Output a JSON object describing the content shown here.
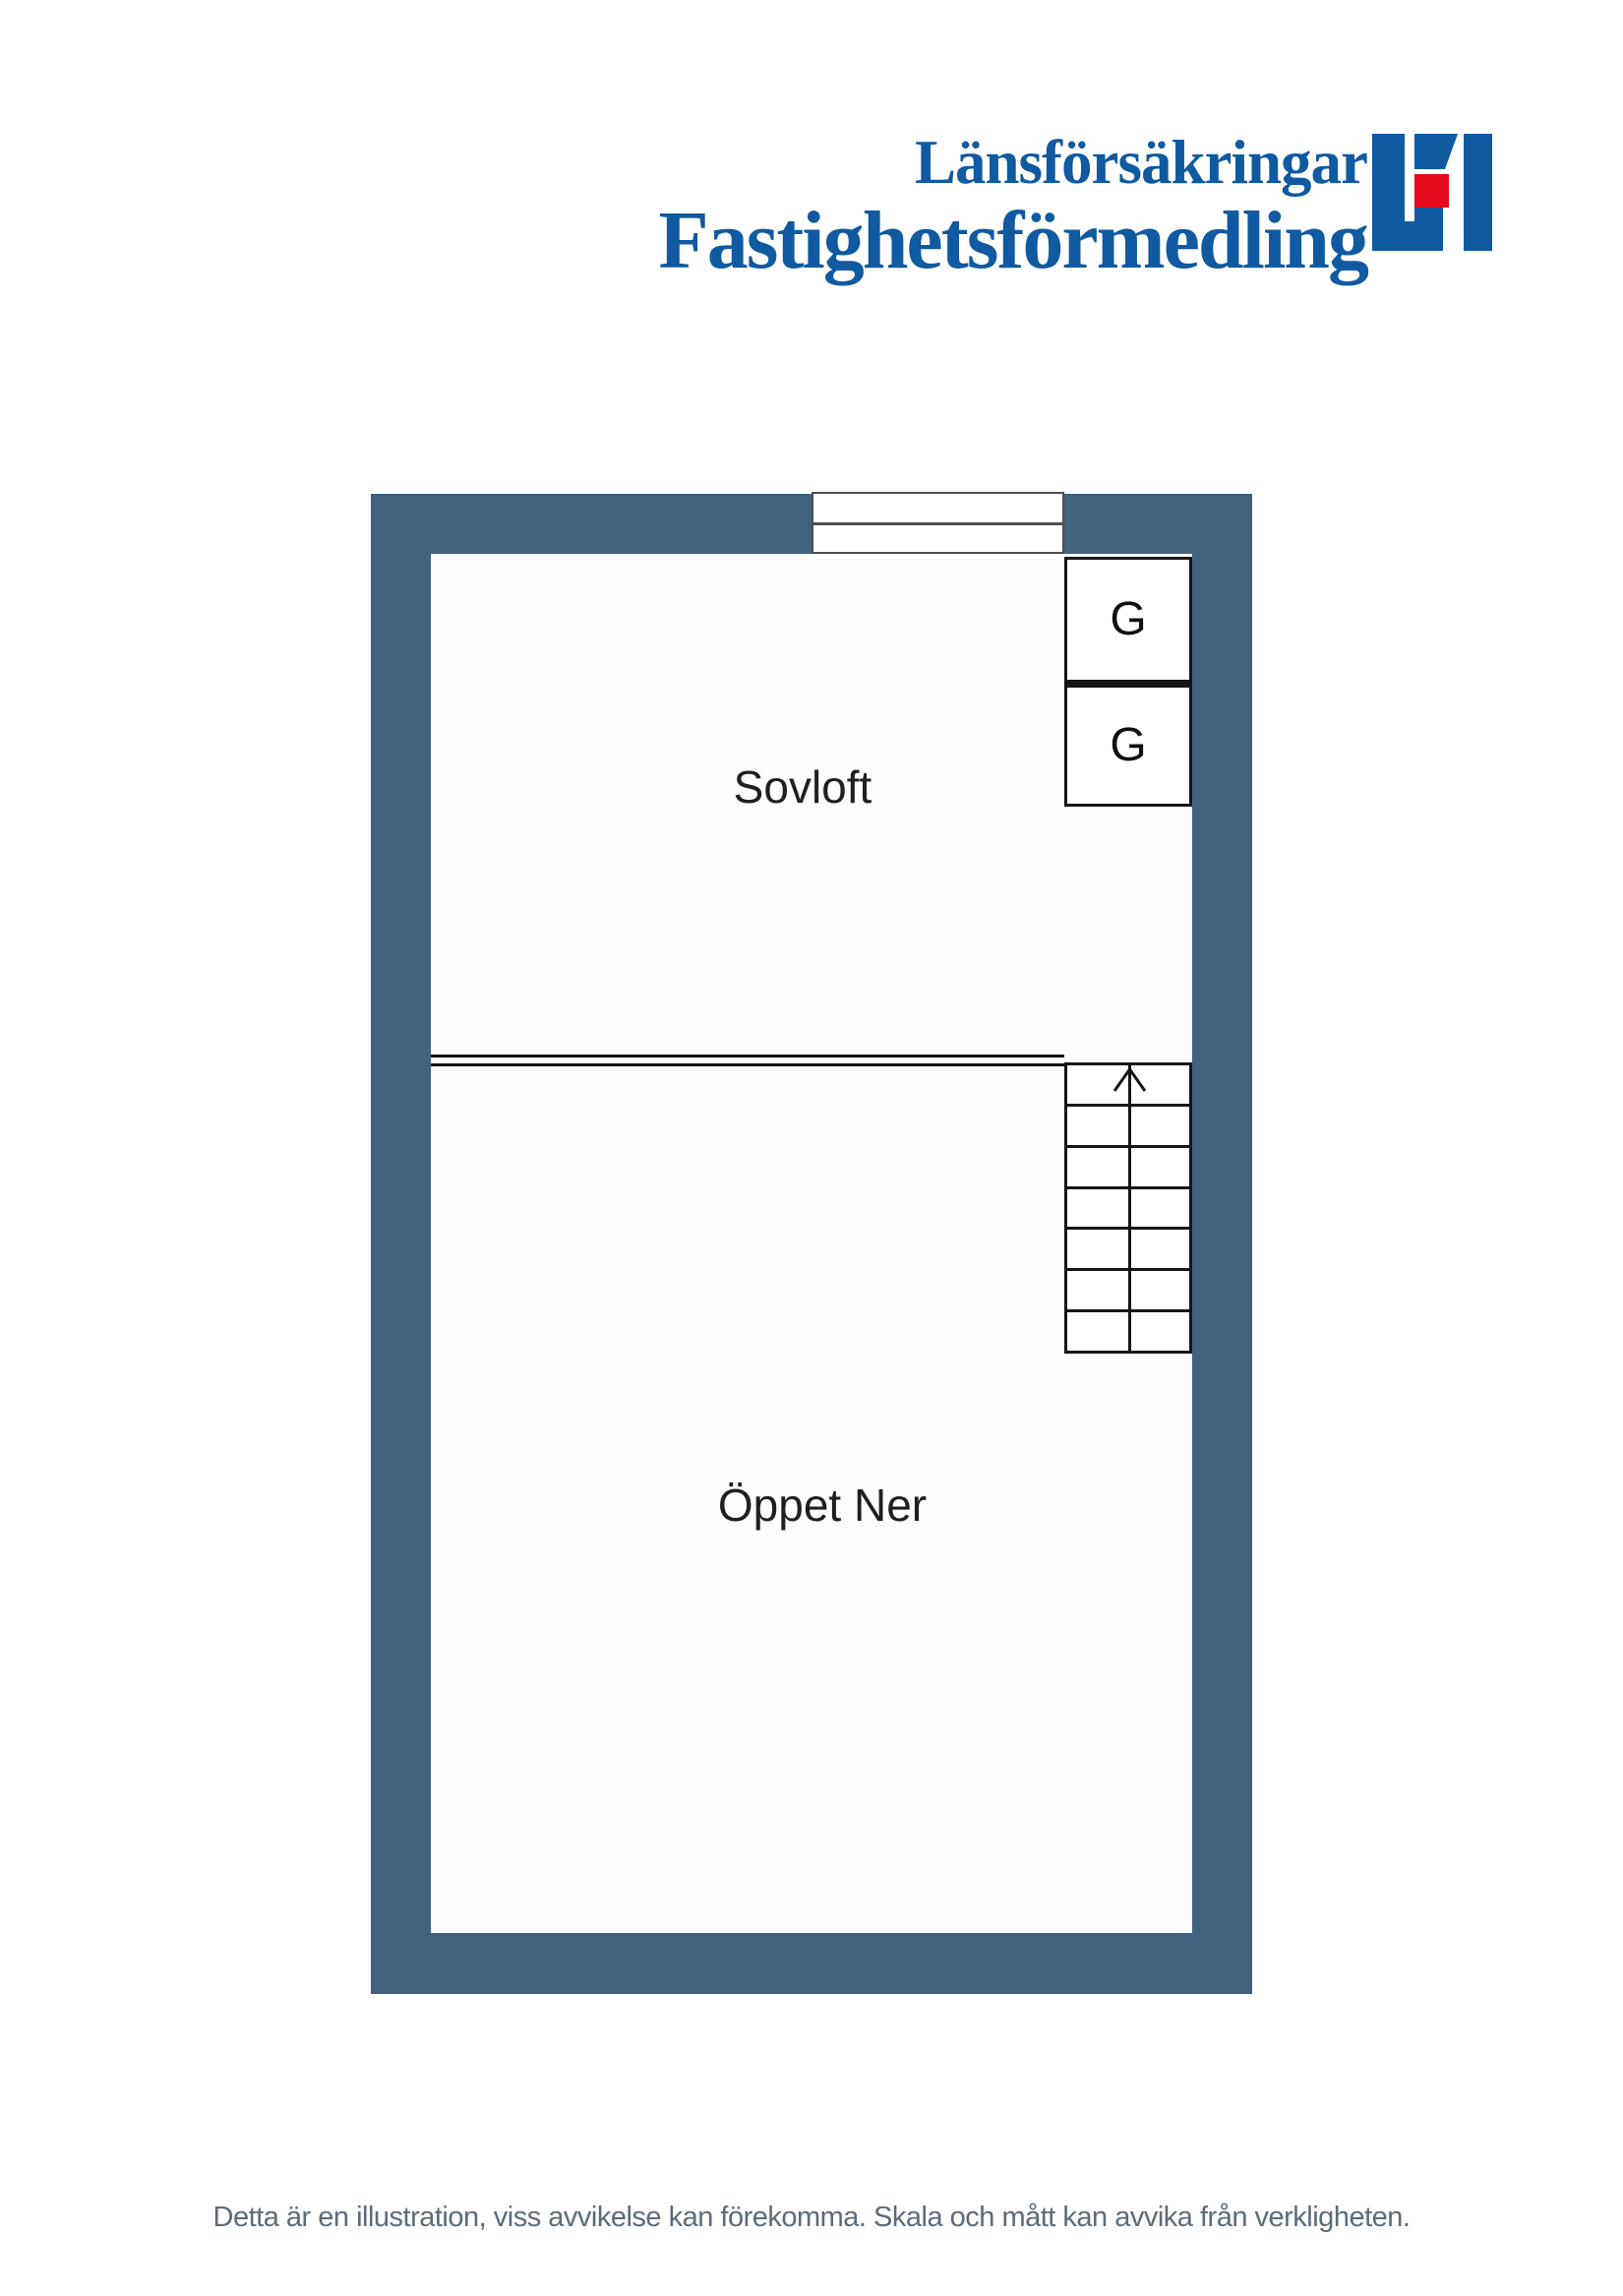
{
  "logo": {
    "line1": "Länsförsäkringar",
    "line2": "Fastighetsförmedling",
    "colors": {
      "blue": "#0f5aa0",
      "red": "#e30b1c"
    }
  },
  "floorplan": {
    "wall_color": "#40627f",
    "line_color": "#161616",
    "rooms": [
      {
        "label": "Sovloft"
      },
      {
        "label": "Öppet Ner"
      }
    ],
    "closets": [
      {
        "label": "G"
      },
      {
        "label": "G"
      }
    ],
    "stairs": {
      "step_rows": 7,
      "direction_arrow": "up"
    }
  },
  "footer": {
    "disclaimer": "Detta är en illustration, viss avvikelse kan förekomma. Skala och mått kan avvika från verkligheten."
  }
}
